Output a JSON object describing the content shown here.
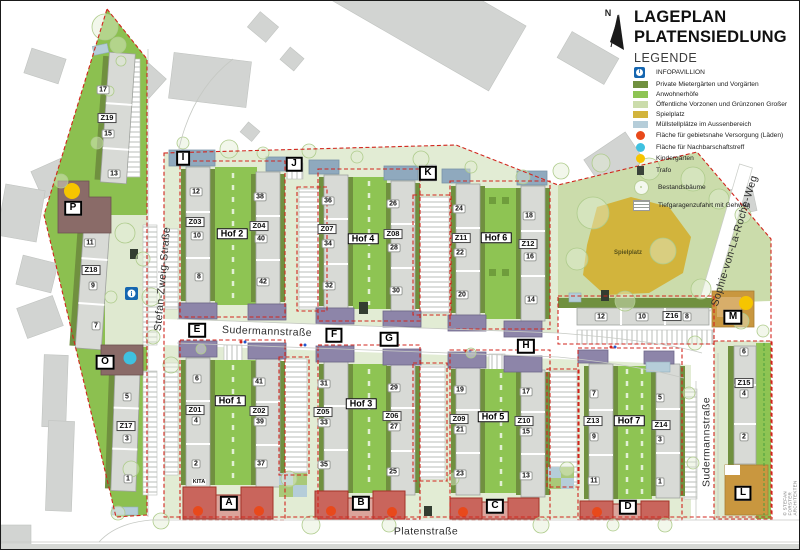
{
  "title": {
    "line1": "LAGEPLAN",
    "line2": "PLATENSIEDLUNG"
  },
  "legend": {
    "heading": "LEGENDE",
    "items": [
      {
        "label": "INFOPAVILLION"
      },
      {
        "label": "Private Mietergärten und Vorgärten"
      },
      {
        "label": "Anwohnerhöfe"
      },
      {
        "label": "Öffentliche Vorzonen und Grünzonen Großer"
      },
      {
        "label": "Spielplatz"
      },
      {
        "label": "Müllstellplätze im Aussenbereich"
      },
      {
        "label": "Fläche für gebietsnahe Versorgung (Läden)"
      },
      {
        "label": "Fläche für Nachbarschaftstreff"
      },
      {
        "label": "Kindergärten"
      },
      {
        "label": "Trafo"
      },
      {
        "label": "Bestandsbäume"
      },
      {
        "label": "Tiefgaragenzufahrt mit Gehweg"
      }
    ]
  },
  "misc": {
    "north": "N",
    "spielplatz": "Spielplatz",
    "kita": "KITA",
    "copyright": "© STEFAN FORSTER ARCHITEKTEN"
  },
  "colors": {
    "private_green": "#70903f",
    "anwohner_green": "#8ec453",
    "public_green": "#cbdcab",
    "spielplatz_gold": "#d2b43c",
    "muell_blue": "#b5cdd9",
    "laden_red": "#e8491b",
    "nachbarschaft_cyan": "#3fc1e0",
    "kindergarten_yellow": "#f6c500",
    "info_blue": "#1566b0",
    "boundary_red": "#d1251d",
    "building_grey": "#d8dad6",
    "cap_purple": "#8d85a9",
    "roof_blue": "#8fa9be",
    "shop_red": "#c9655c",
    "tan": "#c9973f"
  },
  "map": {
    "street_labels": [
      {
        "t": "Stefan-Zweig-Straße",
        "x": 162,
        "y": 278,
        "rot": -85
      },
      {
        "t": "Sudermannstraße",
        "x": 266,
        "y": 331,
        "rot": 2
      },
      {
        "t": "Sudermannstraße",
        "x": 706,
        "y": 441,
        "rot": -90
      },
      {
        "t": "Sophie-von-La-Roche-Weg",
        "x": 734,
        "y": 240,
        "rot": -73
      },
      {
        "t": "Platenstraße",
        "x": 425,
        "y": 531,
        "rot": 0
      }
    ],
    "letters": [
      {
        "t": "A",
        "x": 228,
        "y": 502
      },
      {
        "t": "B",
        "x": 360,
        "y": 502
      },
      {
        "t": "C",
        "x": 494,
        "y": 505
      },
      {
        "t": "D",
        "x": 627,
        "y": 506
      },
      {
        "t": "E",
        "x": 196,
        "y": 329
      },
      {
        "t": "F",
        "x": 333,
        "y": 334
      },
      {
        "t": "G",
        "x": 388,
        "y": 338
      },
      {
        "t": "H",
        "x": 525,
        "y": 345
      },
      {
        "t": "I",
        "x": 182,
        "y": 157
      },
      {
        "t": "J",
        "x": 293,
        "y": 163
      },
      {
        "t": "K",
        "x": 427,
        "y": 172
      },
      {
        "t": "L",
        "x": 742,
        "y": 492
      },
      {
        "t": "M",
        "x": 732,
        "y": 316
      },
      {
        "t": "O",
        "x": 104,
        "y": 361
      },
      {
        "t": "P",
        "x": 72,
        "y": 207
      }
    ],
    "hof_labels": [
      {
        "t": "Hof 1",
        "x": 229,
        "y": 400
      },
      {
        "t": "Hof 2",
        "x": 231,
        "y": 233
      },
      {
        "t": "Hof 3",
        "x": 360,
        "y": 403
      },
      {
        "t": "Hof 4",
        "x": 362,
        "y": 238
      },
      {
        "t": "Hof 5",
        "x": 492,
        "y": 416
      },
      {
        "t": "Hof 6",
        "x": 495,
        "y": 237
      },
      {
        "t": "Hof 7",
        "x": 628,
        "y": 420
      }
    ],
    "z_labels": [
      {
        "t": "Z01",
        "x": 194,
        "y": 409
      },
      {
        "t": "Z02",
        "x": 258,
        "y": 410
      },
      {
        "t": "Z03",
        "x": 194,
        "y": 221
      },
      {
        "t": "Z04",
        "x": 258,
        "y": 225
      },
      {
        "t": "Z05",
        "x": 322,
        "y": 411
      },
      {
        "t": "Z06",
        "x": 391,
        "y": 415
      },
      {
        "t": "Z07",
        "x": 326,
        "y": 228
      },
      {
        "t": "Z08",
        "x": 392,
        "y": 233
      },
      {
        "t": "Z09",
        "x": 458,
        "y": 418
      },
      {
        "t": "Z10",
        "x": 523,
        "y": 420
      },
      {
        "t": "Z11",
        "x": 460,
        "y": 237
      },
      {
        "t": "Z12",
        "x": 527,
        "y": 243
      },
      {
        "t": "Z13",
        "x": 592,
        "y": 420
      },
      {
        "t": "Z14",
        "x": 660,
        "y": 424
      },
      {
        "t": "Z15",
        "x": 743,
        "y": 382
      },
      {
        "t": "Z16",
        "x": 671,
        "y": 315
      },
      {
        "t": "Z17",
        "x": 125,
        "y": 425
      },
      {
        "t": "Z18",
        "x": 90,
        "y": 269
      },
      {
        "t": "Z19",
        "x": 106,
        "y": 117
      }
    ],
    "house_numbers": [
      {
        "t": "17",
        "x": 102,
        "y": 89
      },
      {
        "t": "15",
        "x": 107,
        "y": 133
      },
      {
        "t": "13",
        "x": 113,
        "y": 173
      },
      {
        "t": "11",
        "x": 89,
        "y": 242
      },
      {
        "t": "9",
        "x": 92,
        "y": 285
      },
      {
        "t": "7",
        "x": 95,
        "y": 325
      },
      {
        "t": "5",
        "x": 126,
        "y": 396
      },
      {
        "t": "3",
        "x": 126,
        "y": 438
      },
      {
        "t": "1",
        "x": 127,
        "y": 478
      },
      {
        "t": "12",
        "x": 195,
        "y": 191
      },
      {
        "t": "10",
        "x": 196,
        "y": 235
      },
      {
        "t": "8",
        "x": 198,
        "y": 276
      },
      {
        "t": "38",
        "x": 259,
        "y": 196
      },
      {
        "t": "40",
        "x": 260,
        "y": 238
      },
      {
        "t": "42",
        "x": 262,
        "y": 281
      },
      {
        "t": "36",
        "x": 327,
        "y": 200
      },
      {
        "t": "34",
        "x": 327,
        "y": 243
      },
      {
        "t": "32",
        "x": 328,
        "y": 285
      },
      {
        "t": "26",
        "x": 392,
        "y": 203
      },
      {
        "t": "28",
        "x": 393,
        "y": 247
      },
      {
        "t": "30",
        "x": 395,
        "y": 290
      },
      {
        "t": "24",
        "x": 458,
        "y": 208
      },
      {
        "t": "22",
        "x": 459,
        "y": 252
      },
      {
        "t": "20",
        "x": 461,
        "y": 294
      },
      {
        "t": "18",
        "x": 528,
        "y": 215
      },
      {
        "t": "16",
        "x": 529,
        "y": 256
      },
      {
        "t": "14",
        "x": 530,
        "y": 299
      },
      {
        "t": "12",
        "x": 600,
        "y": 316
      },
      {
        "t": "10",
        "x": 641,
        "y": 316
      },
      {
        "t": "8",
        "x": 686,
        "y": 316
      },
      {
        "t": "6",
        "x": 196,
        "y": 378
      },
      {
        "t": "4",
        "x": 195,
        "y": 420
      },
      {
        "t": "2",
        "x": 195,
        "y": 463
      },
      {
        "t": "41",
        "x": 258,
        "y": 381
      },
      {
        "t": "39",
        "x": 259,
        "y": 421
      },
      {
        "t": "37",
        "x": 260,
        "y": 463
      },
      {
        "t": "31",
        "x": 323,
        "y": 383
      },
      {
        "t": "33",
        "x": 323,
        "y": 422
      },
      {
        "t": "35",
        "x": 323,
        "y": 464
      },
      {
        "t": "29",
        "x": 393,
        "y": 387
      },
      {
        "t": "27",
        "x": 393,
        "y": 426
      },
      {
        "t": "25",
        "x": 392,
        "y": 471
      },
      {
        "t": "19",
        "x": 459,
        "y": 389
      },
      {
        "t": "21",
        "x": 459,
        "y": 429
      },
      {
        "t": "23",
        "x": 459,
        "y": 473
      },
      {
        "t": "17",
        "x": 525,
        "y": 391
      },
      {
        "t": "15",
        "x": 525,
        "y": 431
      },
      {
        "t": "13",
        "x": 525,
        "y": 475
      },
      {
        "t": "7",
        "x": 593,
        "y": 393
      },
      {
        "t": "9",
        "x": 593,
        "y": 436
      },
      {
        "t": "11",
        "x": 593,
        "y": 480
      },
      {
        "t": "5",
        "x": 659,
        "y": 397
      },
      {
        "t": "3",
        "x": 659,
        "y": 439
      },
      {
        "t": "1",
        "x": 659,
        "y": 481
      },
      {
        "t": "6",
        "x": 743,
        "y": 351
      },
      {
        "t": "4",
        "x": 743,
        "y": 393
      },
      {
        "t": "2",
        "x": 743,
        "y": 436
      }
    ]
  }
}
